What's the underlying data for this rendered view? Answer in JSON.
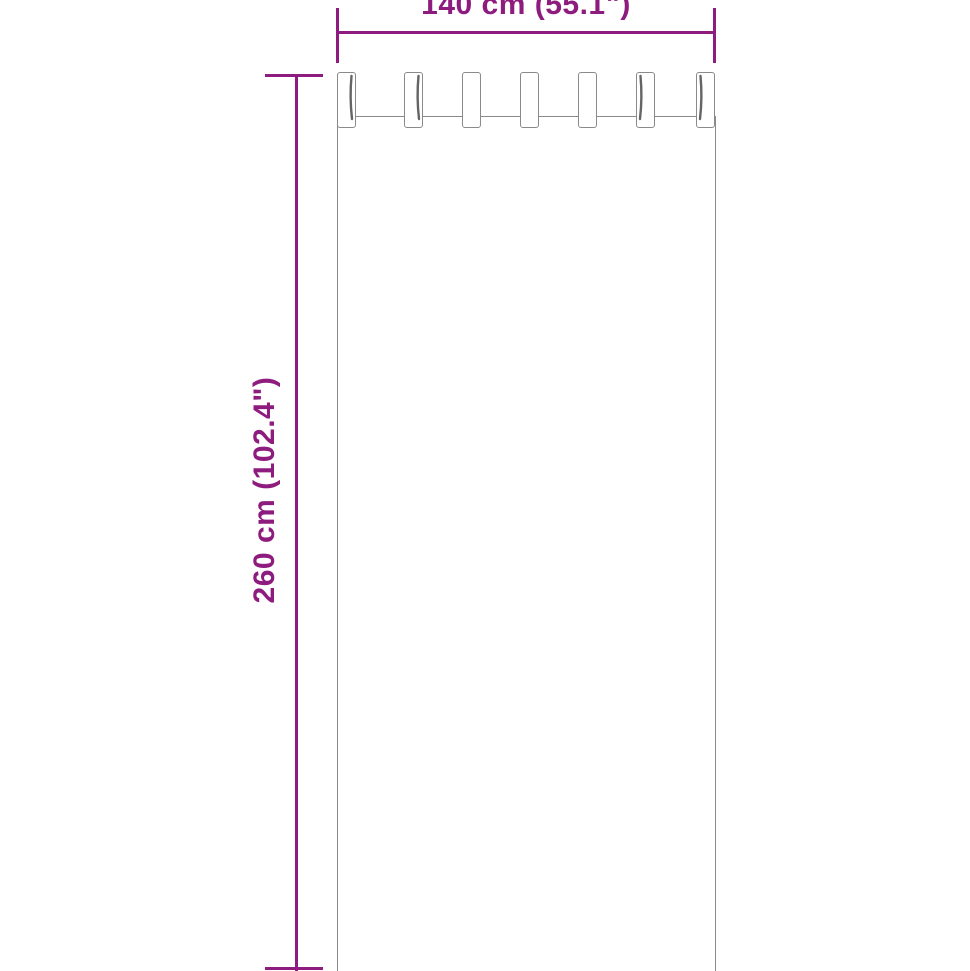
{
  "graphic": "tab-top-curtain-outline-diagram",
  "dimensions": {
    "width": {
      "label": "140 cm (55.1\")"
    },
    "height": {
      "label": "260 cm (102.4\")"
    }
  },
  "curtain": {
    "tab_count": 7
  },
  "colors": {
    "dimension": "#8E1C7E",
    "outline": "#8A8A8A",
    "shadow": "#3F3F3F",
    "background": "#FFFFFF"
  }
}
